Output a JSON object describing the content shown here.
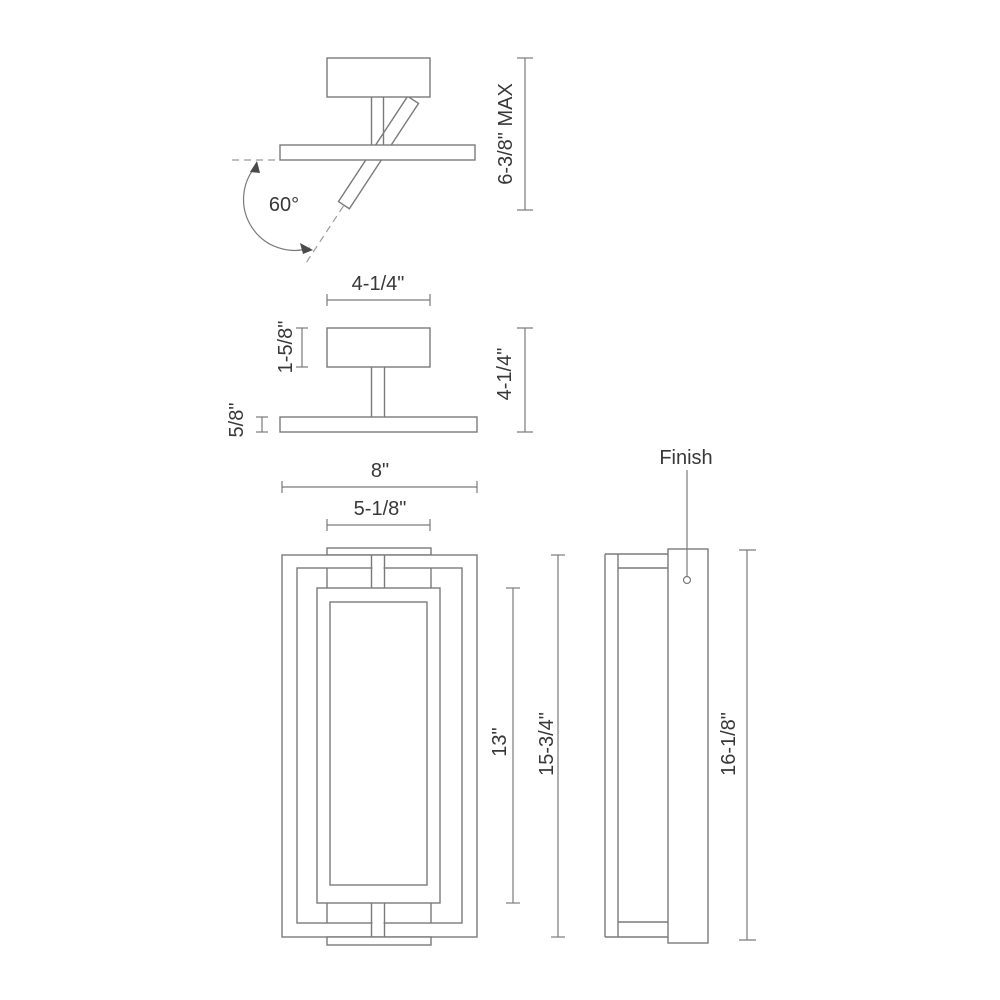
{
  "drawing": {
    "line_color": "#7a7a7a",
    "text_color": "#383838",
    "background": "#ffffff",
    "views": {
      "tilt": {
        "angle_label": "60°",
        "max_height_label": "6-3/8\" MAX"
      },
      "profile": {
        "canopy_width_label": "4-1/4\"",
        "canopy_height_label": "1-5/8\"",
        "bar_thickness_label": "5/8\"",
        "overall_height_label": "4-1/4\""
      },
      "front": {
        "overall_width_label": "8\"",
        "plate_width_label": "5-1/8\"",
        "lens_height_label": "13\"",
        "frame_height_label": "15-3/4\""
      },
      "side": {
        "finish_label": "Finish",
        "overall_height_label": "16-1/8\""
      }
    }
  }
}
